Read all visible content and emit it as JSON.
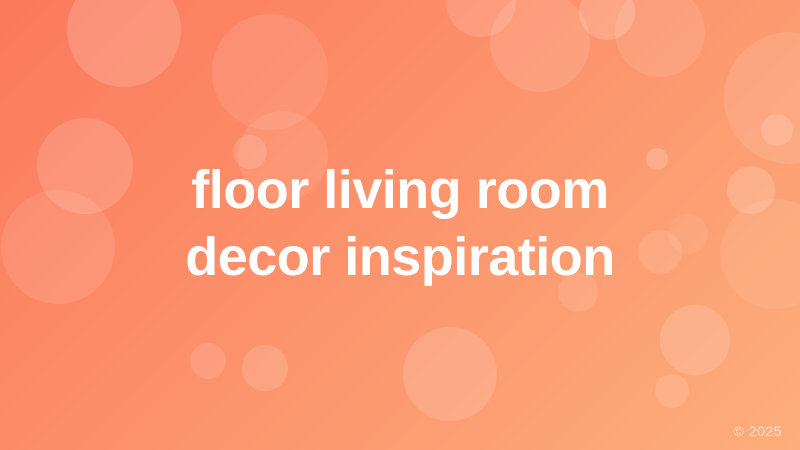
{
  "title": {
    "line1": "floor living room",
    "line2": "decor inspiration"
  },
  "copyright": "© 2025",
  "theme": {
    "gradient_start": "#fb795d",
    "gradient_end": "#fdae7c",
    "gradient_angle_deg": 135,
    "title_color": "#ffffff",
    "copyright_color": "rgba(255,255,255,0.65)",
    "bubble_color_rgb": "255,255,255"
  },
  "background": {
    "bubbles": [
      {
        "x": 124,
        "y": 30,
        "r": 57,
        "opacity": 0.16
      },
      {
        "x": 85,
        "y": 166,
        "r": 48,
        "opacity": 0.14
      },
      {
        "x": 58,
        "y": 247,
        "r": 57,
        "opacity": 0.1
      },
      {
        "x": 270,
        "y": 72,
        "r": 58,
        "opacity": 0.09
      },
      {
        "x": 283,
        "y": 156,
        "r": 45,
        "opacity": 0.09
      },
      {
        "x": 250,
        "y": 152,
        "r": 17,
        "opacity": 0.14
      },
      {
        "x": 481,
        "y": 2,
        "r": 35,
        "opacity": 0.13
      },
      {
        "x": 540,
        "y": 42,
        "r": 50,
        "opacity": 0.12
      },
      {
        "x": 607,
        "y": 12,
        "r": 28,
        "opacity": 0.18
      },
      {
        "x": 660,
        "y": 32,
        "r": 45,
        "opacity": 0.1
      },
      {
        "x": 790,
        "y": 98,
        "r": 66,
        "opacity": 0.1
      },
      {
        "x": 777,
        "y": 130,
        "r": 16,
        "opacity": 0.16
      },
      {
        "x": 657,
        "y": 159,
        "r": 11,
        "opacity": 0.18
      },
      {
        "x": 751,
        "y": 190,
        "r": 24,
        "opacity": 0.16
      },
      {
        "x": 775,
        "y": 254,
        "r": 55,
        "opacity": 0.08
      },
      {
        "x": 688,
        "y": 234,
        "r": 20,
        "opacity": 0.07
      },
      {
        "x": 660,
        "y": 252,
        "r": 22,
        "opacity": 0.1
      },
      {
        "x": 208,
        "y": 361,
        "r": 18,
        "opacity": 0.12
      },
      {
        "x": 265,
        "y": 368,
        "r": 23,
        "opacity": 0.14
      },
      {
        "x": 450,
        "y": 374,
        "r": 47,
        "opacity": 0.14
      },
      {
        "x": 578,
        "y": 292,
        "r": 20,
        "opacity": 0.1
      },
      {
        "x": 695,
        "y": 340,
        "r": 35,
        "opacity": 0.14
      },
      {
        "x": 672,
        "y": 391,
        "r": 17,
        "opacity": 0.12
      }
    ]
  }
}
